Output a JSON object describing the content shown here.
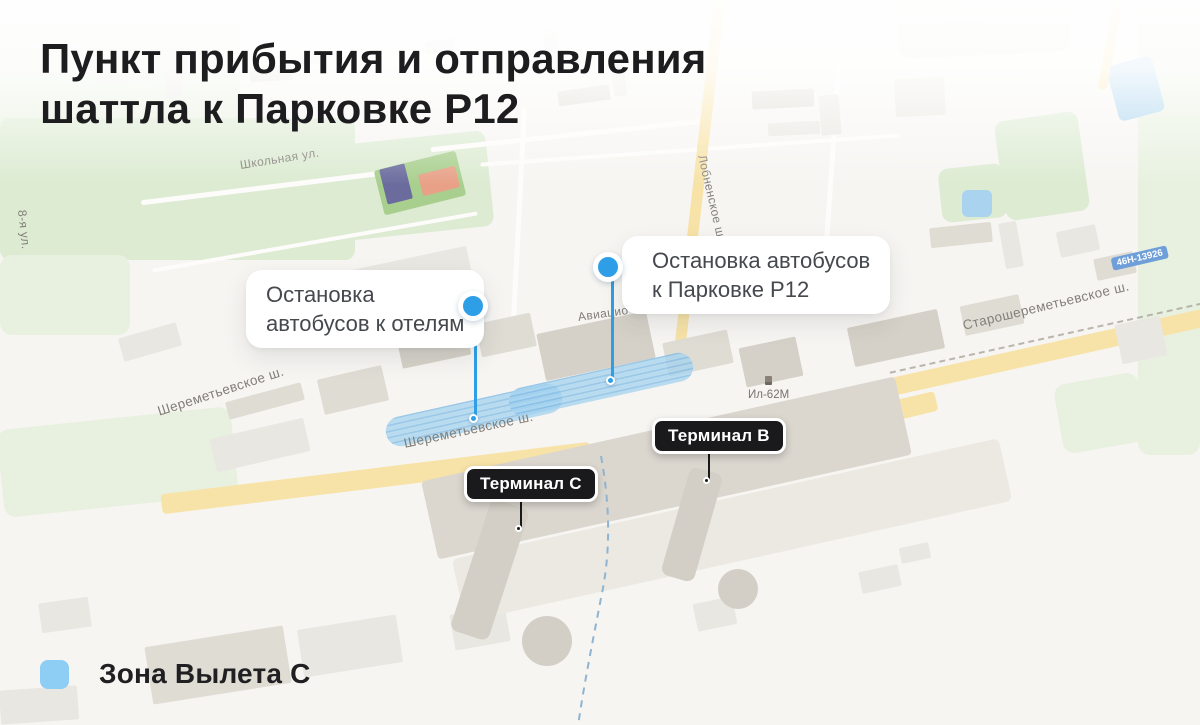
{
  "title": {
    "line1": "Пункт прибытия и отправления",
    "line2": "шаттла к Парковке P12"
  },
  "callouts": {
    "hotels": {
      "line1": "Остановка",
      "line2": "автобусов к отелям"
    },
    "parking": {
      "line1": "Остановка автобусов",
      "line2": "к Парковке P12"
    }
  },
  "terminals": {
    "c": "Терминал C",
    "b": "Терминал B"
  },
  "legend": {
    "label": "Зона Вылета C"
  },
  "map_labels": {
    "sheremetyevskoe_left": "Шереметьевское ш.",
    "sheremetyevskoe_center": "Шереметьевское ш.",
    "starosheremetyevskoe": "Старошереметьевское ш.",
    "lobnenskoe": "Лобненское ш.",
    "shkolnaya": "Школьная ул.",
    "aviatsionnaya": "Авиацио",
    "vosmaya_ulitsa": "8-я ул.",
    "il62m": "Ил-62М",
    "route_badge": "46Н-13926"
  },
  "colors": {
    "accent_blue": "#2e9fe7",
    "zone_blue": "#8ecdf4",
    "terminal_badge_bg": "#1a1a1c",
    "road_yellow": "#f7e3a8",
    "title_text": "#1d1d1f"
  }
}
